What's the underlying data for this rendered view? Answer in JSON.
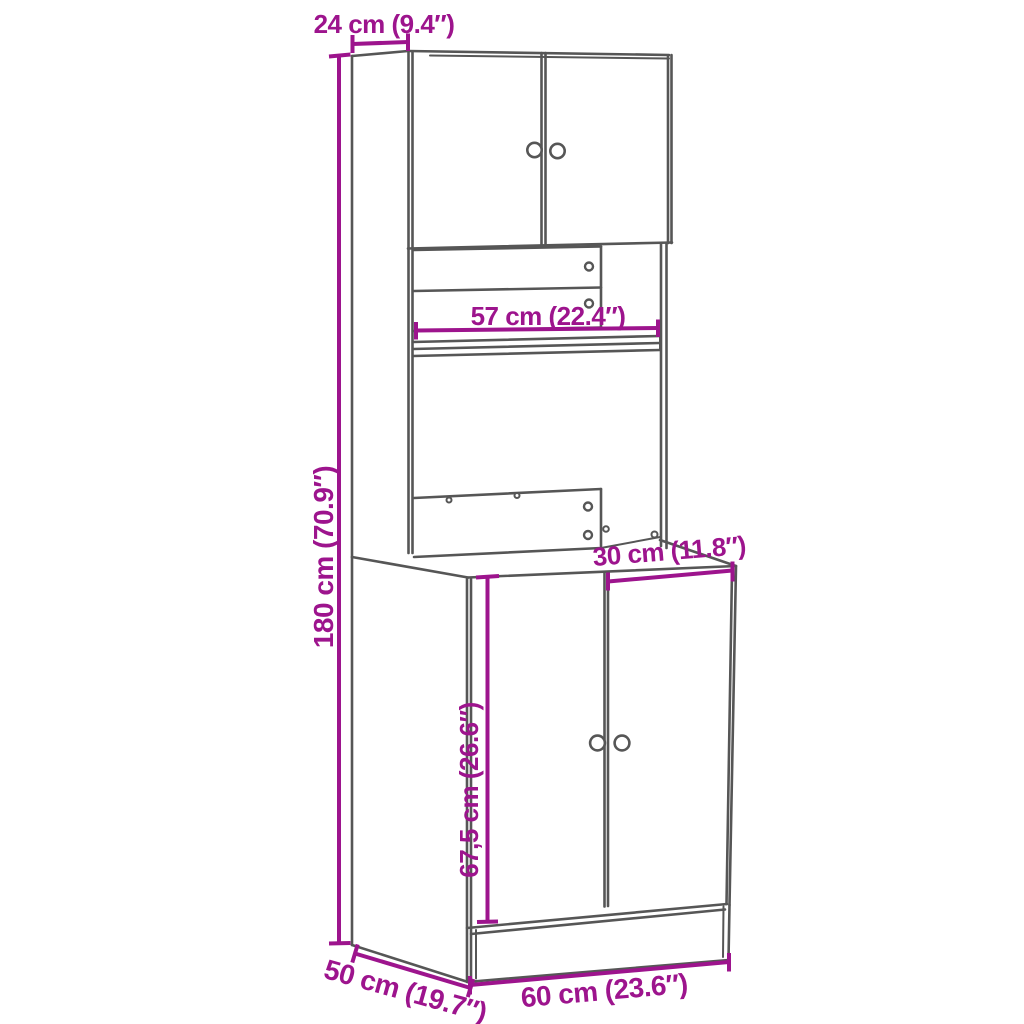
{
  "diagram": {
    "colors": {
      "background": "#ffffff",
      "line": "#565656",
      "dimension": "#9d148d"
    },
    "dimensions": {
      "top_depth": {
        "label": "24 cm (9.4″)"
      },
      "total_height": {
        "label": "180 cm (70.9″)"
      },
      "niche_width": {
        "label": "57 cm (22.4″)"
      },
      "counter_depth": {
        "label": "30 cm (11.8″)"
      },
      "lower_door_height": {
        "label": "67,5 cm (26.6″)"
      },
      "width": {
        "label": "60 cm (23.6″)"
      },
      "depth": {
        "label": "50 cm (19.7″)"
      }
    }
  }
}
